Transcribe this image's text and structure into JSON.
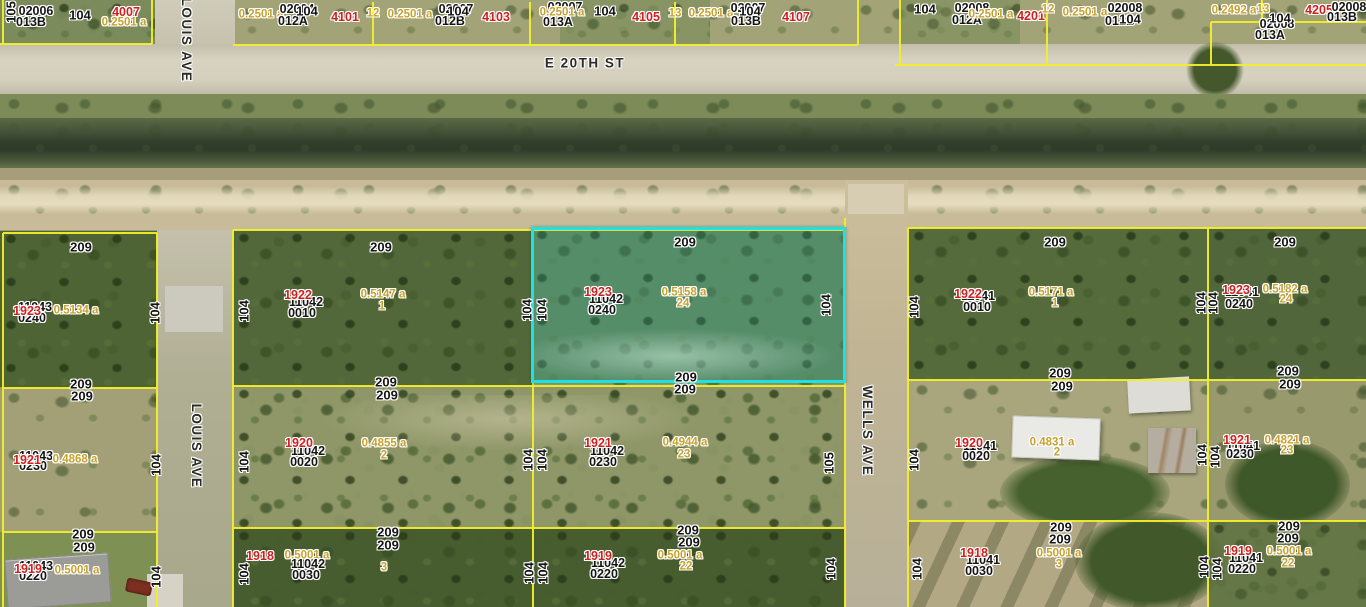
{
  "selected_parcel": {
    "strap": "1923 11042 0240",
    "red_number": "1923",
    "plat": "11042",
    "lot_code": "0240",
    "area": "0.5158 a",
    "lot": "24"
  },
  "streets": {
    "horizontal": "E 20TH ST",
    "vertical_left": "LOUIS AVE",
    "vertical_right": "WELLS AVE"
  },
  "colors": {
    "boundary_line": "#f2ee2b",
    "highlight": "#1ee2e2",
    "red_label": "#d01f1f",
    "area_label": "#c9a22d",
    "black_label": "#141414"
  },
  "labels": [
    {
      "t": "105",
      "x": 11,
      "y": 12,
      "k": "dim",
      "r": "u"
    },
    {
      "t": "02006",
      "x": 36,
      "y": 11,
      "k": "id"
    },
    {
      "t": "013B",
      "x": 31,
      "y": 22,
      "k": "id"
    },
    {
      "t": "104",
      "x": 80,
      "y": 15,
      "k": "dim"
    },
    {
      "t": "4007",
      "x": 126,
      "y": 12,
      "k": "red"
    },
    {
      "t": "0.2501 a",
      "x": 124,
      "y": 23,
      "k": "area"
    },
    {
      "t": "LOUIS AVE",
      "x": 186,
      "y": 40,
      "k": "street",
      "r": "d"
    },
    {
      "t": "0.2501 a",
      "x": 261,
      "y": 15,
      "k": "area"
    },
    {
      "t": "02004",
      "x": 297,
      "y": 9,
      "k": "id"
    },
    {
      "t": "012A",
      "x": 293,
      "y": 21,
      "k": "id"
    },
    {
      "t": "104",
      "x": 307,
      "y": 11,
      "k": "dim"
    },
    {
      "t": "4101",
      "x": 345,
      "y": 17,
      "k": "red"
    },
    {
      "t": "12",
      "x": 373,
      "y": 14,
      "k": "area"
    },
    {
      "t": "0.2501 a",
      "x": 410,
      "y": 15,
      "k": "area"
    },
    {
      "t": "02007",
      "x": 456,
      "y": 9,
      "k": "id"
    },
    {
      "t": "012B",
      "x": 450,
      "y": 21,
      "k": "id"
    },
    {
      "t": "104",
      "x": 458,
      "y": 11,
      "k": "dim"
    },
    {
      "t": "4103",
      "x": 496,
      "y": 17,
      "k": "red"
    },
    {
      "t": "02007",
      "x": 565,
      "y": 7,
      "k": "id"
    },
    {
      "t": "0.2501 a",
      "x": 562,
      "y": 13,
      "k": "area"
    },
    {
      "t": "013A",
      "x": 558,
      "y": 22,
      "k": "id"
    },
    {
      "t": "104",
      "x": 605,
      "y": 11,
      "k": "dim"
    },
    {
      "t": "4105",
      "x": 646,
      "y": 17,
      "k": "red"
    },
    {
      "t": "13",
      "x": 675,
      "y": 14,
      "k": "area"
    },
    {
      "t": "0.2501 a",
      "x": 711,
      "y": 14,
      "k": "area"
    },
    {
      "t": "02007",
      "x": 748,
      "y": 8,
      "k": "id"
    },
    {
      "t": "013B",
      "x": 746,
      "y": 21,
      "k": "id"
    },
    {
      "t": "104",
      "x": 750,
      "y": 11,
      "k": "dim"
    },
    {
      "t": "4107",
      "x": 796,
      "y": 17,
      "k": "red"
    },
    {
      "t": "104",
      "x": 925,
      "y": 9,
      "k": "dim"
    },
    {
      "t": "02008",
      "x": 972,
      "y": 8,
      "k": "id"
    },
    {
      "t": "012A",
      "x": 967,
      "y": 20,
      "k": "id"
    },
    {
      "t": "0.2501 a",
      "x": 991,
      "y": 15,
      "k": "area"
    },
    {
      "t": "4201",
      "x": 1031,
      "y": 16,
      "k": "red"
    },
    {
      "t": "12",
      "x": 1048,
      "y": 10,
      "k": "area"
    },
    {
      "t": "0.2501 a",
      "x": 1085,
      "y": 13,
      "k": "area"
    },
    {
      "t": "02008",
      "x": 1125,
      "y": 8,
      "k": "id"
    },
    {
      "t": "012B",
      "x": 1120,
      "y": 21,
      "k": "id"
    },
    {
      "t": "104",
      "x": 1130,
      "y": 19,
      "k": "dim"
    },
    {
      "t": "0.2492 a",
      "x": 1234,
      "y": 11,
      "k": "area"
    },
    {
      "t": "13",
      "x": 1263,
      "y": 10,
      "k": "area"
    },
    {
      "t": "4205",
      "x": 1319,
      "y": 10,
      "k": "red"
    },
    {
      "t": "02008",
      "x": 1349,
      "y": 7,
      "k": "id"
    },
    {
      "t": "013B",
      "x": 1342,
      "y": 17,
      "k": "id"
    },
    {
      "t": "02008",
      "x": 1277,
      "y": 24,
      "k": "id"
    },
    {
      "t": "013A",
      "x": 1270,
      "y": 35,
      "k": "id"
    },
    {
      "t": "104",
      "x": 1280,
      "y": 18,
      "k": "dim"
    },
    {
      "t": "E 20TH ST",
      "x": 585,
      "y": 63,
      "k": "street"
    },
    {
      "t": "LOUIS AVE",
      "x": 196,
      "y": 446,
      "k": "street",
      "r": "d"
    },
    {
      "t": "WELLS AVE",
      "x": 867,
      "y": 431,
      "k": "street",
      "r": "d"
    },
    {
      "t": "209",
      "x": 81,
      "y": 247,
      "k": "dim"
    },
    {
      "t": "11043",
      "x": 35,
      "y": 307,
      "k": "id"
    },
    {
      "t": "0240",
      "x": 32,
      "y": 318,
      "k": "id"
    },
    {
      "t": "1923",
      "x": 27,
      "y": 311,
      "k": "red"
    },
    {
      "t": "0.5134 a",
      "x": 76,
      "y": 311,
      "k": "area"
    },
    {
      "t": "104",
      "x": 155,
      "y": 313,
      "k": "dim",
      "r": "u"
    },
    {
      "t": "104",
      "x": 244,
      "y": 311,
      "k": "dim",
      "r": "u"
    },
    {
      "t": "209",
      "x": 381,
      "y": 247,
      "k": "dim"
    },
    {
      "t": "11042",
      "x": 306,
      "y": 302,
      "k": "id"
    },
    {
      "t": "0010",
      "x": 302,
      "y": 313,
      "k": "id"
    },
    {
      "t": "1922",
      "x": 298,
      "y": 295,
      "k": "red"
    },
    {
      "t": "0.5147 a",
      "x": 383,
      "y": 295,
      "k": "area"
    },
    {
      "t": "1",
      "x": 382,
      "y": 307,
      "k": "area"
    },
    {
      "t": "104",
      "x": 527,
      "y": 310,
      "k": "dim",
      "r": "u"
    },
    {
      "t": "104",
      "x": 542,
      "y": 310,
      "k": "dim",
      "r": "u"
    },
    {
      "t": "209",
      "x": 685,
      "y": 242,
      "k": "dim"
    },
    {
      "t": "11042",
      "x": 606,
      "y": 299,
      "k": "id"
    },
    {
      "t": "0240",
      "x": 602,
      "y": 310,
      "k": "id"
    },
    {
      "t": "1923",
      "x": 598,
      "y": 292,
      "k": "red"
    },
    {
      "t": "0.5158 a",
      "x": 684,
      "y": 293,
      "k": "area"
    },
    {
      "t": "24",
      "x": 683,
      "y": 304,
      "k": "area"
    },
    {
      "t": "104",
      "x": 826,
      "y": 305,
      "k": "dim",
      "r": "u"
    },
    {
      "t": "209",
      "x": 1055,
      "y": 242,
      "k": "dim"
    },
    {
      "t": "104",
      "x": 914,
      "y": 307,
      "k": "dim",
      "r": "u"
    },
    {
      "t": "11041",
      "x": 978,
      "y": 296,
      "k": "id"
    },
    {
      "t": "0010",
      "x": 977,
      "y": 307,
      "k": "id"
    },
    {
      "t": "1922",
      "x": 968,
      "y": 294,
      "k": "red"
    },
    {
      "t": "0.5171 a",
      "x": 1051,
      "y": 293,
      "k": "area"
    },
    {
      "t": "1",
      "x": 1055,
      "y": 304,
      "k": "area"
    },
    {
      "t": "104",
      "x": 1201,
      "y": 303,
      "k": "dim",
      "r": "u"
    },
    {
      "t": "104",
      "x": 1213,
      "y": 303,
      "k": "dim",
      "r": "u"
    },
    {
      "t": "209",
      "x": 1285,
      "y": 242,
      "k": "dim"
    },
    {
      "t": "11041",
      "x": 1242,
      "y": 292,
      "k": "id"
    },
    {
      "t": "0240",
      "x": 1239,
      "y": 304,
      "k": "id"
    },
    {
      "t": "1923",
      "x": 1236,
      "y": 290,
      "k": "red"
    },
    {
      "t": "0.5182 a",
      "x": 1285,
      "y": 290,
      "k": "area"
    },
    {
      "t": "24",
      "x": 1286,
      "y": 300,
      "k": "area"
    },
    {
      "t": "209",
      "x": 81,
      "y": 384,
      "k": "dim"
    },
    {
      "t": "209",
      "x": 82,
      "y": 396,
      "k": "dim"
    },
    {
      "t": "209",
      "x": 386,
      "y": 382,
      "k": "dim"
    },
    {
      "t": "209",
      "x": 387,
      "y": 395,
      "k": "dim"
    },
    {
      "t": "209",
      "x": 686,
      "y": 377,
      "k": "dim"
    },
    {
      "t": "209",
      "x": 685,
      "y": 389,
      "k": "dim"
    },
    {
      "t": "209",
      "x": 1060,
      "y": 373,
      "k": "dim"
    },
    {
      "t": "209",
      "x": 1062,
      "y": 386,
      "k": "dim"
    },
    {
      "t": "209",
      "x": 1288,
      "y": 371,
      "k": "dim"
    },
    {
      "t": "209",
      "x": 1290,
      "y": 384,
      "k": "dim"
    },
    {
      "t": "11043",
      "x": 36,
      "y": 456,
      "k": "id"
    },
    {
      "t": "0230",
      "x": 33,
      "y": 466,
      "k": "id"
    },
    {
      "t": "1921",
      "x": 27,
      "y": 460,
      "k": "red"
    },
    {
      "t": "0.4868 a",
      "x": 75,
      "y": 460,
      "k": "area"
    },
    {
      "t": "104",
      "x": 156,
      "y": 465,
      "k": "dim",
      "r": "u"
    },
    {
      "t": "104",
      "x": 244,
      "y": 462,
      "k": "dim",
      "r": "u"
    },
    {
      "t": "11042",
      "x": 308,
      "y": 451,
      "k": "id"
    },
    {
      "t": "0020",
      "x": 304,
      "y": 462,
      "k": "id"
    },
    {
      "t": "1920",
      "x": 299,
      "y": 443,
      "k": "red"
    },
    {
      "t": "0.4855 a",
      "x": 384,
      "y": 444,
      "k": "area"
    },
    {
      "t": "2",
      "x": 384,
      "y": 456,
      "k": "area"
    },
    {
      "t": "104",
      "x": 528,
      "y": 460,
      "k": "dim",
      "r": "u"
    },
    {
      "t": "104",
      "x": 542,
      "y": 460,
      "k": "dim",
      "r": "u"
    },
    {
      "t": "11042",
      "x": 607,
      "y": 451,
      "k": "id"
    },
    {
      "t": "0230",
      "x": 603,
      "y": 462,
      "k": "id"
    },
    {
      "t": "1921",
      "x": 598,
      "y": 443,
      "k": "red"
    },
    {
      "t": "0.4944 a",
      "x": 685,
      "y": 443,
      "k": "area"
    },
    {
      "t": "23",
      "x": 684,
      "y": 455,
      "k": "area"
    },
    {
      "t": "105",
      "x": 829,
      "y": 463,
      "k": "dim",
      "r": "u"
    },
    {
      "t": "104",
      "x": 914,
      "y": 460,
      "k": "dim",
      "r": "u"
    },
    {
      "t": "11041",
      "x": 980,
      "y": 446,
      "k": "id"
    },
    {
      "t": "0020",
      "x": 976,
      "y": 456,
      "k": "id"
    },
    {
      "t": "1920",
      "x": 969,
      "y": 443,
      "k": "red"
    },
    {
      "t": "0.4831 a",
      "x": 1052,
      "y": 443,
      "k": "area"
    },
    {
      "t": "2",
      "x": 1057,
      "y": 453,
      "k": "area"
    },
    {
      "t": "104",
      "x": 1202,
      "y": 455,
      "k": "dim",
      "r": "u"
    },
    {
      "t": "104",
      "x": 1215,
      "y": 457,
      "k": "dim",
      "r": "u"
    },
    {
      "t": "11041",
      "x": 1243,
      "y": 446,
      "k": "id"
    },
    {
      "t": "0230",
      "x": 1240,
      "y": 454,
      "k": "id"
    },
    {
      "t": "1921",
      "x": 1237,
      "y": 440,
      "k": "red"
    },
    {
      "t": "0.4821 a",
      "x": 1287,
      "y": 441,
      "k": "area"
    },
    {
      "t": "23",
      "x": 1287,
      "y": 451,
      "k": "area"
    },
    {
      "t": "209",
      "x": 83,
      "y": 534,
      "k": "dim"
    },
    {
      "t": "209",
      "x": 84,
      "y": 547,
      "k": "dim"
    },
    {
      "t": "209",
      "x": 388,
      "y": 532,
      "k": "dim"
    },
    {
      "t": "209",
      "x": 388,
      "y": 545,
      "k": "dim"
    },
    {
      "t": "209",
      "x": 688,
      "y": 530,
      "k": "dim"
    },
    {
      "t": "209",
      "x": 689,
      "y": 542,
      "k": "dim"
    },
    {
      "t": "209",
      "x": 1061,
      "y": 527,
      "k": "dim"
    },
    {
      "t": "209",
      "x": 1060,
      "y": 539,
      "k": "dim"
    },
    {
      "t": "209",
      "x": 1289,
      "y": 526,
      "k": "dim"
    },
    {
      "t": "209",
      "x": 1288,
      "y": 538,
      "k": "dim"
    },
    {
      "t": "11043",
      "x": 36,
      "y": 566,
      "k": "id"
    },
    {
      "t": "0220",
      "x": 33,
      "y": 576,
      "k": "id"
    },
    {
      "t": "1919",
      "x": 28,
      "y": 569,
      "k": "red"
    },
    {
      "t": "0.5001 a",
      "x": 77,
      "y": 571,
      "k": "area"
    },
    {
      "t": "104",
      "x": 156,
      "y": 577,
      "k": "dim",
      "r": "u"
    },
    {
      "t": "104",
      "x": 244,
      "y": 574,
      "k": "dim",
      "r": "u"
    },
    {
      "t": "1918",
      "x": 260,
      "y": 556,
      "k": "red"
    },
    {
      "t": "0.5001 a",
      "x": 307,
      "y": 556,
      "k": "area"
    },
    {
      "t": "11042",
      "x": 308,
      "y": 564,
      "k": "id"
    },
    {
      "t": "0030",
      "x": 306,
      "y": 575,
      "k": "id"
    },
    {
      "t": "3",
      "x": 384,
      "y": 568,
      "k": "area"
    },
    {
      "t": "104",
      "x": 529,
      "y": 573,
      "k": "dim",
      "r": "u"
    },
    {
      "t": "104",
      "x": 543,
      "y": 573,
      "k": "dim",
      "r": "u"
    },
    {
      "t": "11042",
      "x": 608,
      "y": 563,
      "k": "id"
    },
    {
      "t": "0220",
      "x": 604,
      "y": 574,
      "k": "id"
    },
    {
      "t": "1919",
      "x": 598,
      "y": 556,
      "k": "red"
    },
    {
      "t": "0.5001 a",
      "x": 680,
      "y": 556,
      "k": "area"
    },
    {
      "t": "22",
      "x": 686,
      "y": 567,
      "k": "area"
    },
    {
      "t": "104",
      "x": 831,
      "y": 569,
      "k": "dim",
      "r": "u"
    },
    {
      "t": "104",
      "x": 917,
      "y": 569,
      "k": "dim",
      "r": "u"
    },
    {
      "t": "11041",
      "x": 983,
      "y": 560,
      "k": "id"
    },
    {
      "t": "0030",
      "x": 979,
      "y": 571,
      "k": "id"
    },
    {
      "t": "1918",
      "x": 974,
      "y": 553,
      "k": "red"
    },
    {
      "t": "0.5001 a",
      "x": 1059,
      "y": 554,
      "k": "area"
    },
    {
      "t": "3",
      "x": 1059,
      "y": 565,
      "k": "area"
    },
    {
      "t": "104",
      "x": 1204,
      "y": 567,
      "k": "dim",
      "r": "u"
    },
    {
      "t": "104",
      "x": 1217,
      "y": 569,
      "k": "dim",
      "r": "u"
    },
    {
      "t": "11041",
      "x": 1246,
      "y": 558,
      "k": "id"
    },
    {
      "t": "0220",
      "x": 1242,
      "y": 569,
      "k": "id"
    },
    {
      "t": "1919",
      "x": 1238,
      "y": 551,
      "k": "red"
    },
    {
      "t": "0.5001 a",
      "x": 1289,
      "y": 552,
      "k": "area"
    },
    {
      "t": "22",
      "x": 1288,
      "y": 564,
      "k": "area"
    }
  ]
}
